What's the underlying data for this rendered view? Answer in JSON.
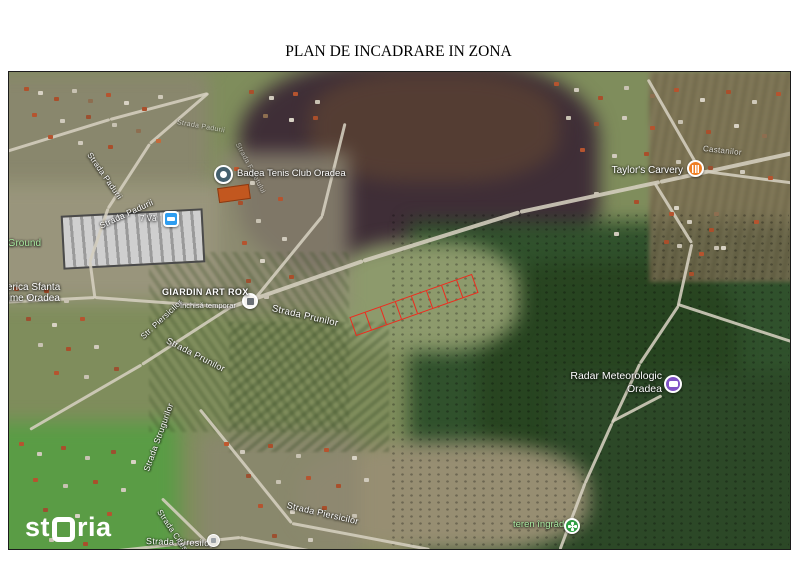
{
  "title": {
    "line1": "PLAN DE INCADRARE IN ZONA",
    "line2": "a imobilelor identificate prin nr. cad.213836, 213837, 213838, 213839, 213840,",
    "line3": "213841, 213842,  213835 Oradea"
  },
  "map": {
    "watermark_st": "st",
    "watermark_ria": "ria",
    "watermark_full": "storia",
    "pois": {
      "tennis": {
        "label": "Badea Tenis Club Oradea",
        "icon": "tennis-pin",
        "color": "#44606e"
      },
      "taylors": {
        "label": "Taylor's Carvery",
        "icon": "restaurant-pin",
        "color": "#ef7e23"
      },
      "lodging": {
        "label": "7 Vă",
        "icon": "lodging-pin",
        "color": "#2e9df0"
      },
      "giardin": {
        "label": "GIARDIN ART ROX",
        "status": "Închisă temporar",
        "icon": "shop-pin",
        "color": "#f5f3f0"
      },
      "radar": {
        "label_line1": "Radar Meteorologic",
        "label_line2": "Oradea",
        "icon": "attraction-pin",
        "color": "#8153c6"
      },
      "church": {
        "label_line1": "Biserica Sfanta",
        "label_line2": "Treime Oradea"
      },
      "teren": {
        "label": "teren îngrăd",
        "icon": "park-pin",
        "color": "#2f9e44"
      },
      "ciresilor_poi": {
        "icon": "generic-pin",
        "color": "#e8e6e1"
      }
    },
    "streets": [
      {
        "text": "Strada Padurii"
      },
      {
        "text": "Strada Padurii"
      },
      {
        "text": "Strada Padurii"
      },
      {
        "text": "Strada Fagetului"
      },
      {
        "text": "Castanilor"
      },
      {
        "text": "Strada Prunilor"
      },
      {
        "text": "Strada Prunilor"
      },
      {
        "text": "Str. Piersicilor"
      },
      {
        "text": "Strada Strugurilor"
      },
      {
        "text": "Strada Piersicilor"
      },
      {
        "text": "Strada Ciresilor"
      },
      {
        "text": "Strada Ciresilor"
      }
    ],
    "areas": [
      {
        "text": "KGround"
      }
    ],
    "parcels": {
      "count": 8,
      "outline_color": "#ee2b1e"
    }
  }
}
